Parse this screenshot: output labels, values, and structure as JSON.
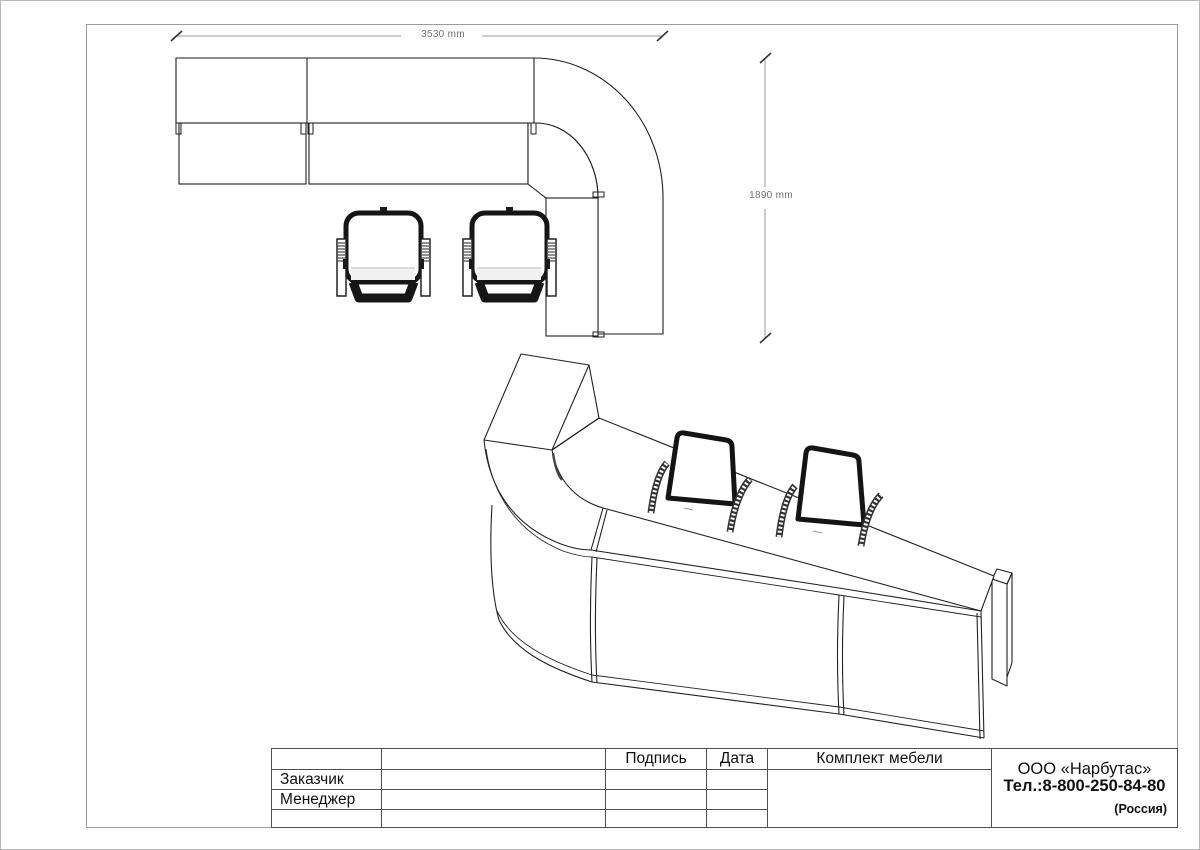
{
  "sheet": {
    "kind": "furniture technical drawing"
  },
  "plan_view": {
    "dim_width": "3530 mm",
    "dim_depth": "1890 mm"
  },
  "title_block": {
    "col_signature": "Подпись",
    "col_date": "Дата",
    "drawing_title": "Комплект мебели",
    "row_customer": "Заказчик",
    "row_manager": "Менеджер",
    "company_name": "ООО «Нарбутас»",
    "company_phone": "Тел.:8-800-250-84-80",
    "company_country": "(Россия)"
  },
  "colors": {
    "line": "#1a1a1a",
    "dim_line": "#999999",
    "dim_text": "#6f6f6f",
    "frame": "#9c9c9c",
    "table_line": "#4f4f4f"
  }
}
